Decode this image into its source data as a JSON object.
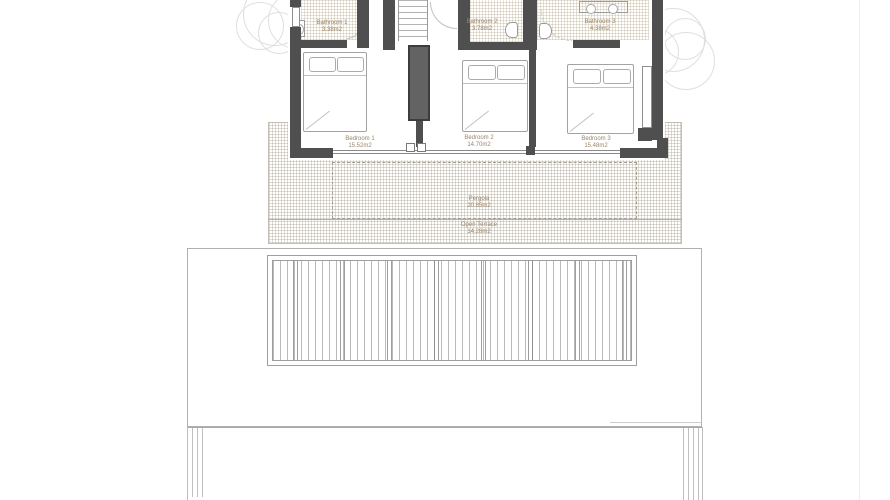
{
  "drawing": {
    "type": "floor-plan",
    "rooms": {
      "bathroom1": {
        "name": "Bathroom 1",
        "area": "3.38m2"
      },
      "bathroom2": {
        "name": "Bathroom 2",
        "area": "3.78m2"
      },
      "bathroom3": {
        "name": "Bathroom 3",
        "area": "4.38m2"
      },
      "bedroom1": {
        "name": "Bedroom 1",
        "area": "15.52m2"
      },
      "bedroom2": {
        "name": "Bedroom 2",
        "area": "14.70m2"
      },
      "bedroom3": {
        "name": "Bedroom 3",
        "area": "15.48m2"
      },
      "pergola": {
        "name": "Pergola",
        "area": "20.85m2"
      },
      "open_terrace": {
        "name": "Open Terrace",
        "area": "14.28m2"
      }
    },
    "colors": {
      "wall": "#4f4f4f",
      "label": "#9b8468",
      "line": "#b8b8b8",
      "grid": "#c4beb2",
      "background": "#ffffff"
    }
  }
}
